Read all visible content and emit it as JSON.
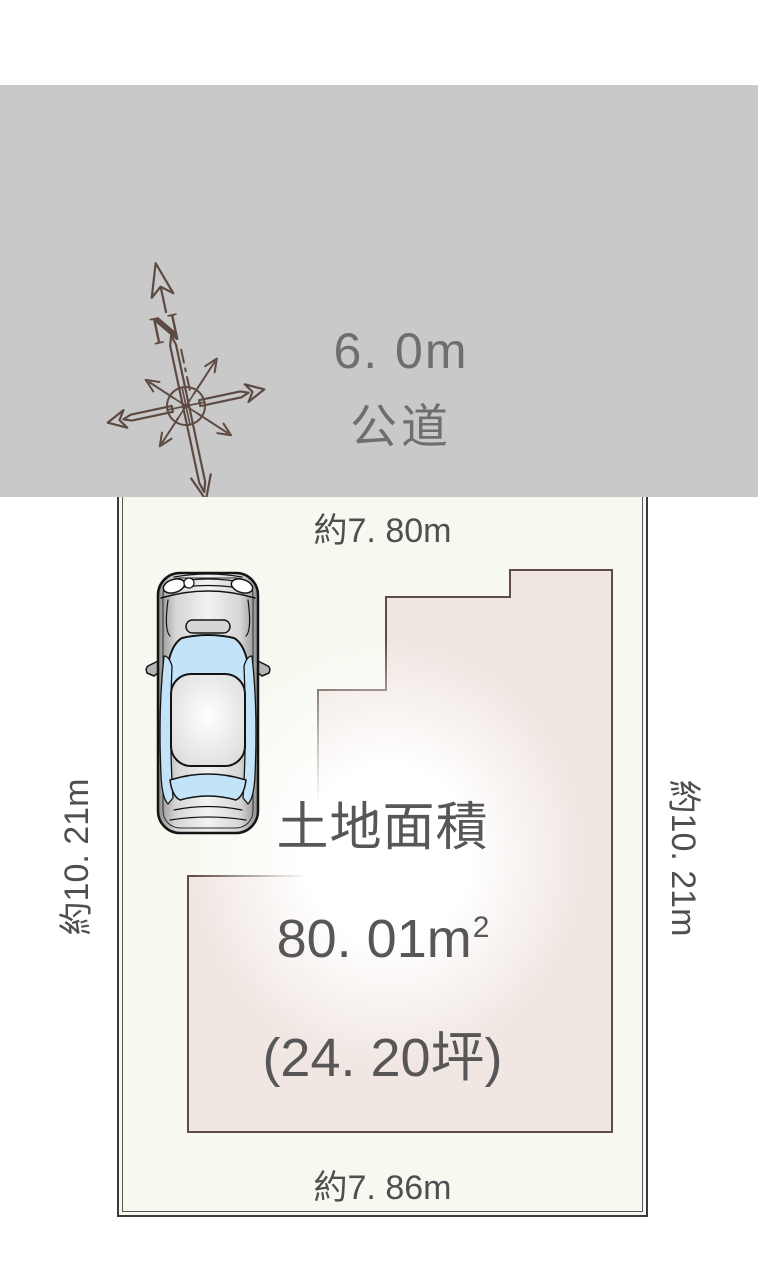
{
  "road": {
    "width_label": "6. 0m",
    "surface_label": "公道"
  },
  "compass": {
    "north_label": "N"
  },
  "plot": {
    "dimensions": {
      "top": "約7. 80m",
      "bottom": "約7. 86m",
      "left": "約10. 21m",
      "right": "約10. 21m"
    },
    "area": {
      "title": "土地面積",
      "value_m2": "80. 01m",
      "value_m2_sup": "2",
      "value_tsubo": "(24. 20坪)"
    },
    "footprint_points": "510,570 612,570 612,1132 188,1132 188,876 318,876 318,690 386,690 386,597 510,597"
  },
  "colors": {
    "road_band": "#c9c9c9",
    "road_text": "#6e6e6e",
    "compass": "#5d4a42",
    "plot_background": "#f7f9f1",
    "plot_border": "#3a3a3a",
    "footprint_fill": "#f0e6e2",
    "footprint_stroke": "#5f4c42",
    "dimension_text": "#4f4f4f",
    "area_text": "#575757",
    "car_glass": "#c3e3f8"
  }
}
